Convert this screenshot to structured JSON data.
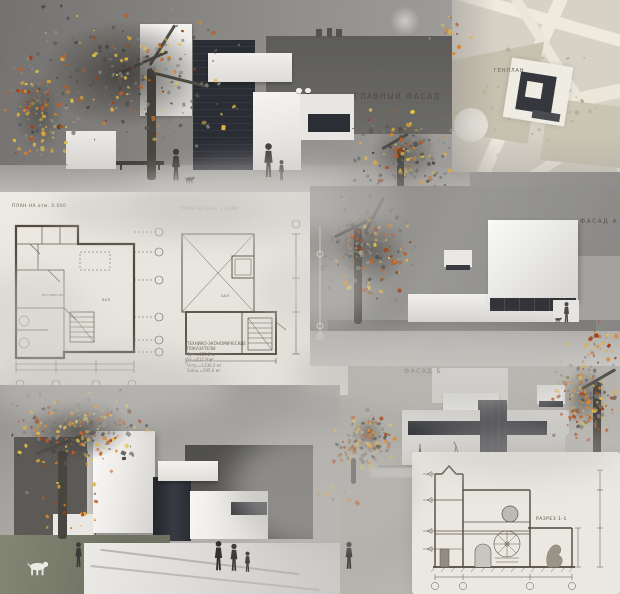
{
  "labels": {
    "main_facade": "ГЛАВНЫЙ ФАСАД",
    "genplan": "ГЕНПЛАН",
    "plan_left_title": "ПЛАН НА отм. 0.000",
    "plan_right_title": "ПЛАН НА отм. +3.000",
    "facade_a": "ФАСАД А",
    "facade_b": "ФАСАД Б",
    "section": "РАЗРЕЗ 1-1"
  },
  "plans": {
    "left_hall": "ЗАЛ",
    "left_vestibule": "ВЕСТИБЮЛЬ",
    "right_hall": "ЗАЛ"
  },
  "tech_indicators": {
    "heading_line1": "ТЕХНИКО-ЭКОНОМИЧЕСКИЕ",
    "heading_line2": "ПОКАЗАТЕЛИ:",
    "rows": [
      "Sуч.=458.8 м²",
      "Sз.=412.9 м²",
      "Vстр.=1336.2 м³",
      "Sобщ.=295.0 м²"
    ]
  },
  "colors": {
    "autumn_accent": "#c85a1c",
    "autumn_accent2": "#e2a438",
    "drawing_ink": "#5a5348",
    "dark_glazing": "#2e3038",
    "paper": "#ece9e2"
  }
}
